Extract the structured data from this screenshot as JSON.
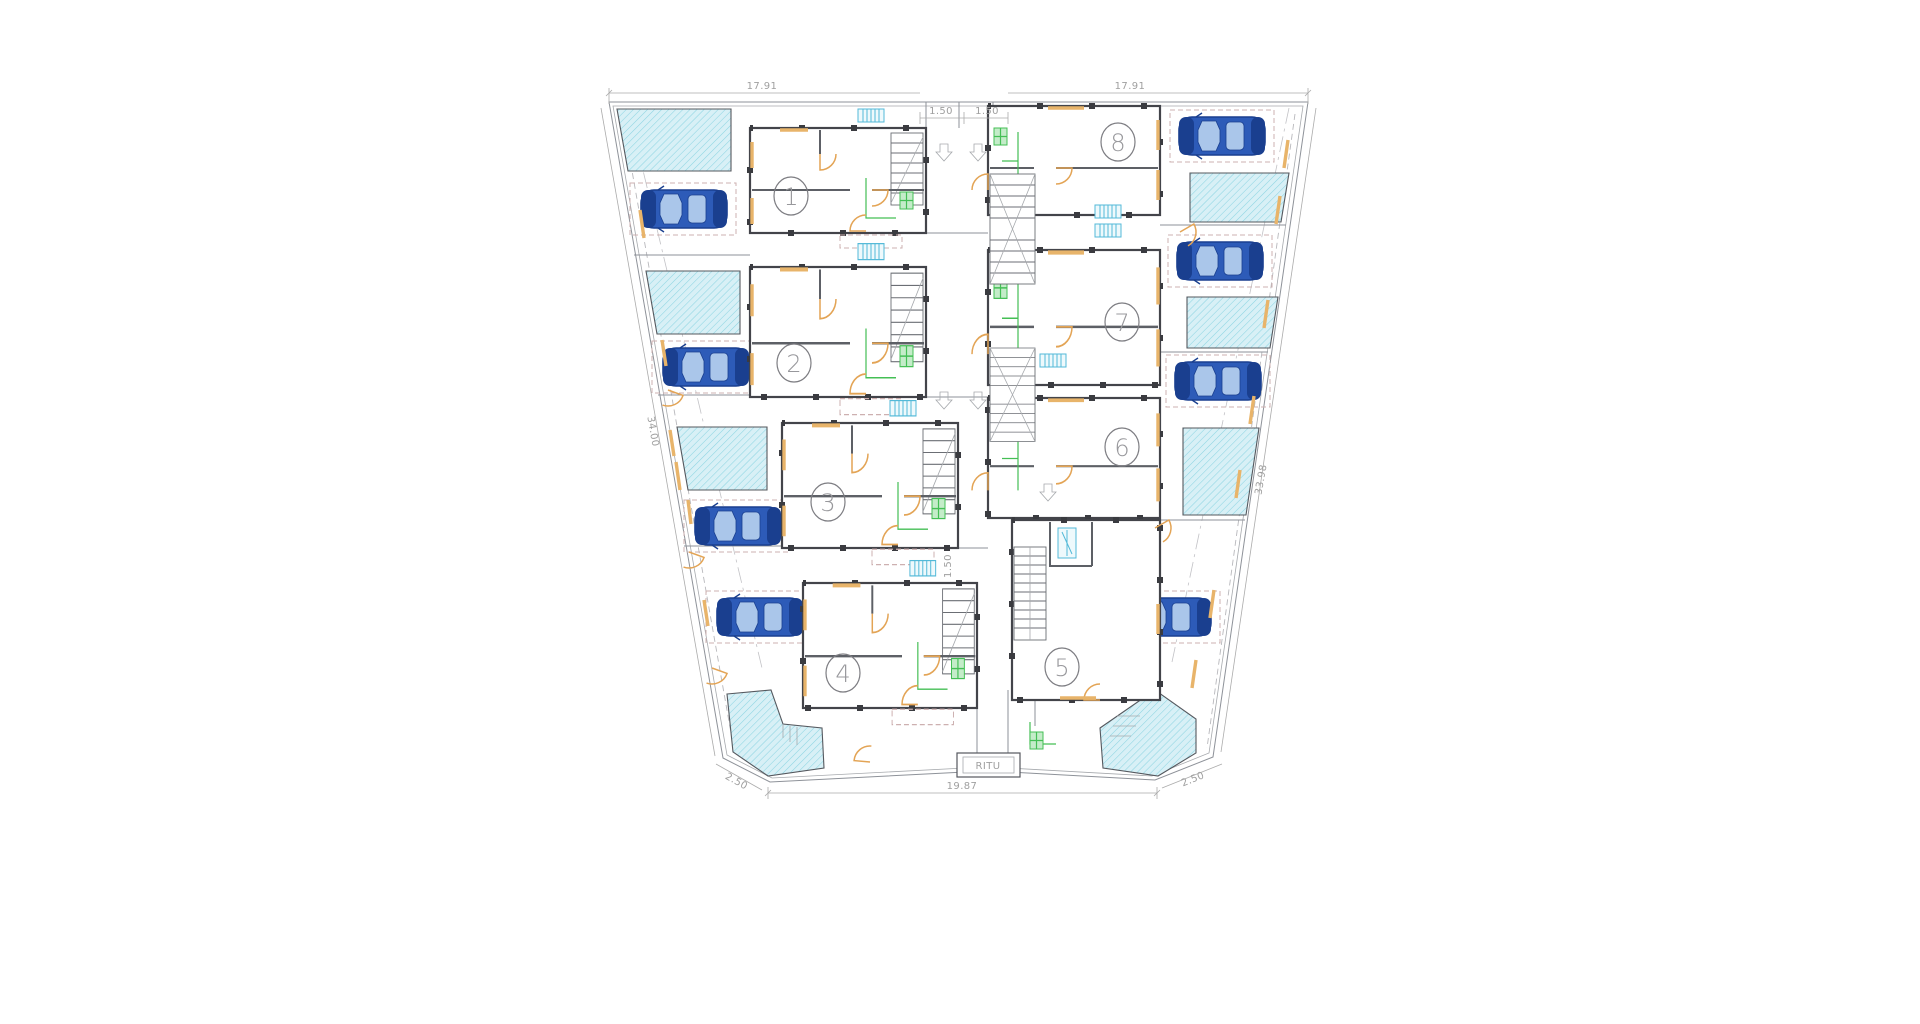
{
  "drawing": {
    "title": "Ground floor site plan with eight dwelling units",
    "units": [
      {
        "number": "1"
      },
      {
        "number": "2"
      },
      {
        "number": "3"
      },
      {
        "number": "4"
      },
      {
        "number": "5"
      },
      {
        "number": "6"
      },
      {
        "number": "7"
      },
      {
        "number": "8"
      }
    ],
    "annotations": {
      "street_box": "RITU"
    },
    "dimensions": {
      "top_left": "17.91",
      "top_right": "17.91",
      "front_setback_left": "1.50",
      "front_setback_right": "1.50",
      "side_left": "34.00",
      "side_right": "33.98",
      "passage": "1.50",
      "bottom_width": "19.87",
      "bottom_corner_left": "2.50",
      "bottom_corner_right": "2.50"
    },
    "site": {
      "unit_count": 8,
      "parking_spaces": 8,
      "pools": 8
    }
  },
  "colors": {
    "car-body": "#2d5bb8",
    "car-dark": "#1a3f8f",
    "car-glass": "#aac6ea",
    "pool-fill": "#d8f0f6",
    "pool-hatch": "#8ed5e2",
    "door-orange": "#e3a455",
    "accent-orange": "#e8b46a",
    "kitchen-green": "#44bf55",
    "vent-cyan": "#53b9d8",
    "wall": "#43444a",
    "dim": "#9f9f9f",
    "paper": "#ffffff"
  }
}
